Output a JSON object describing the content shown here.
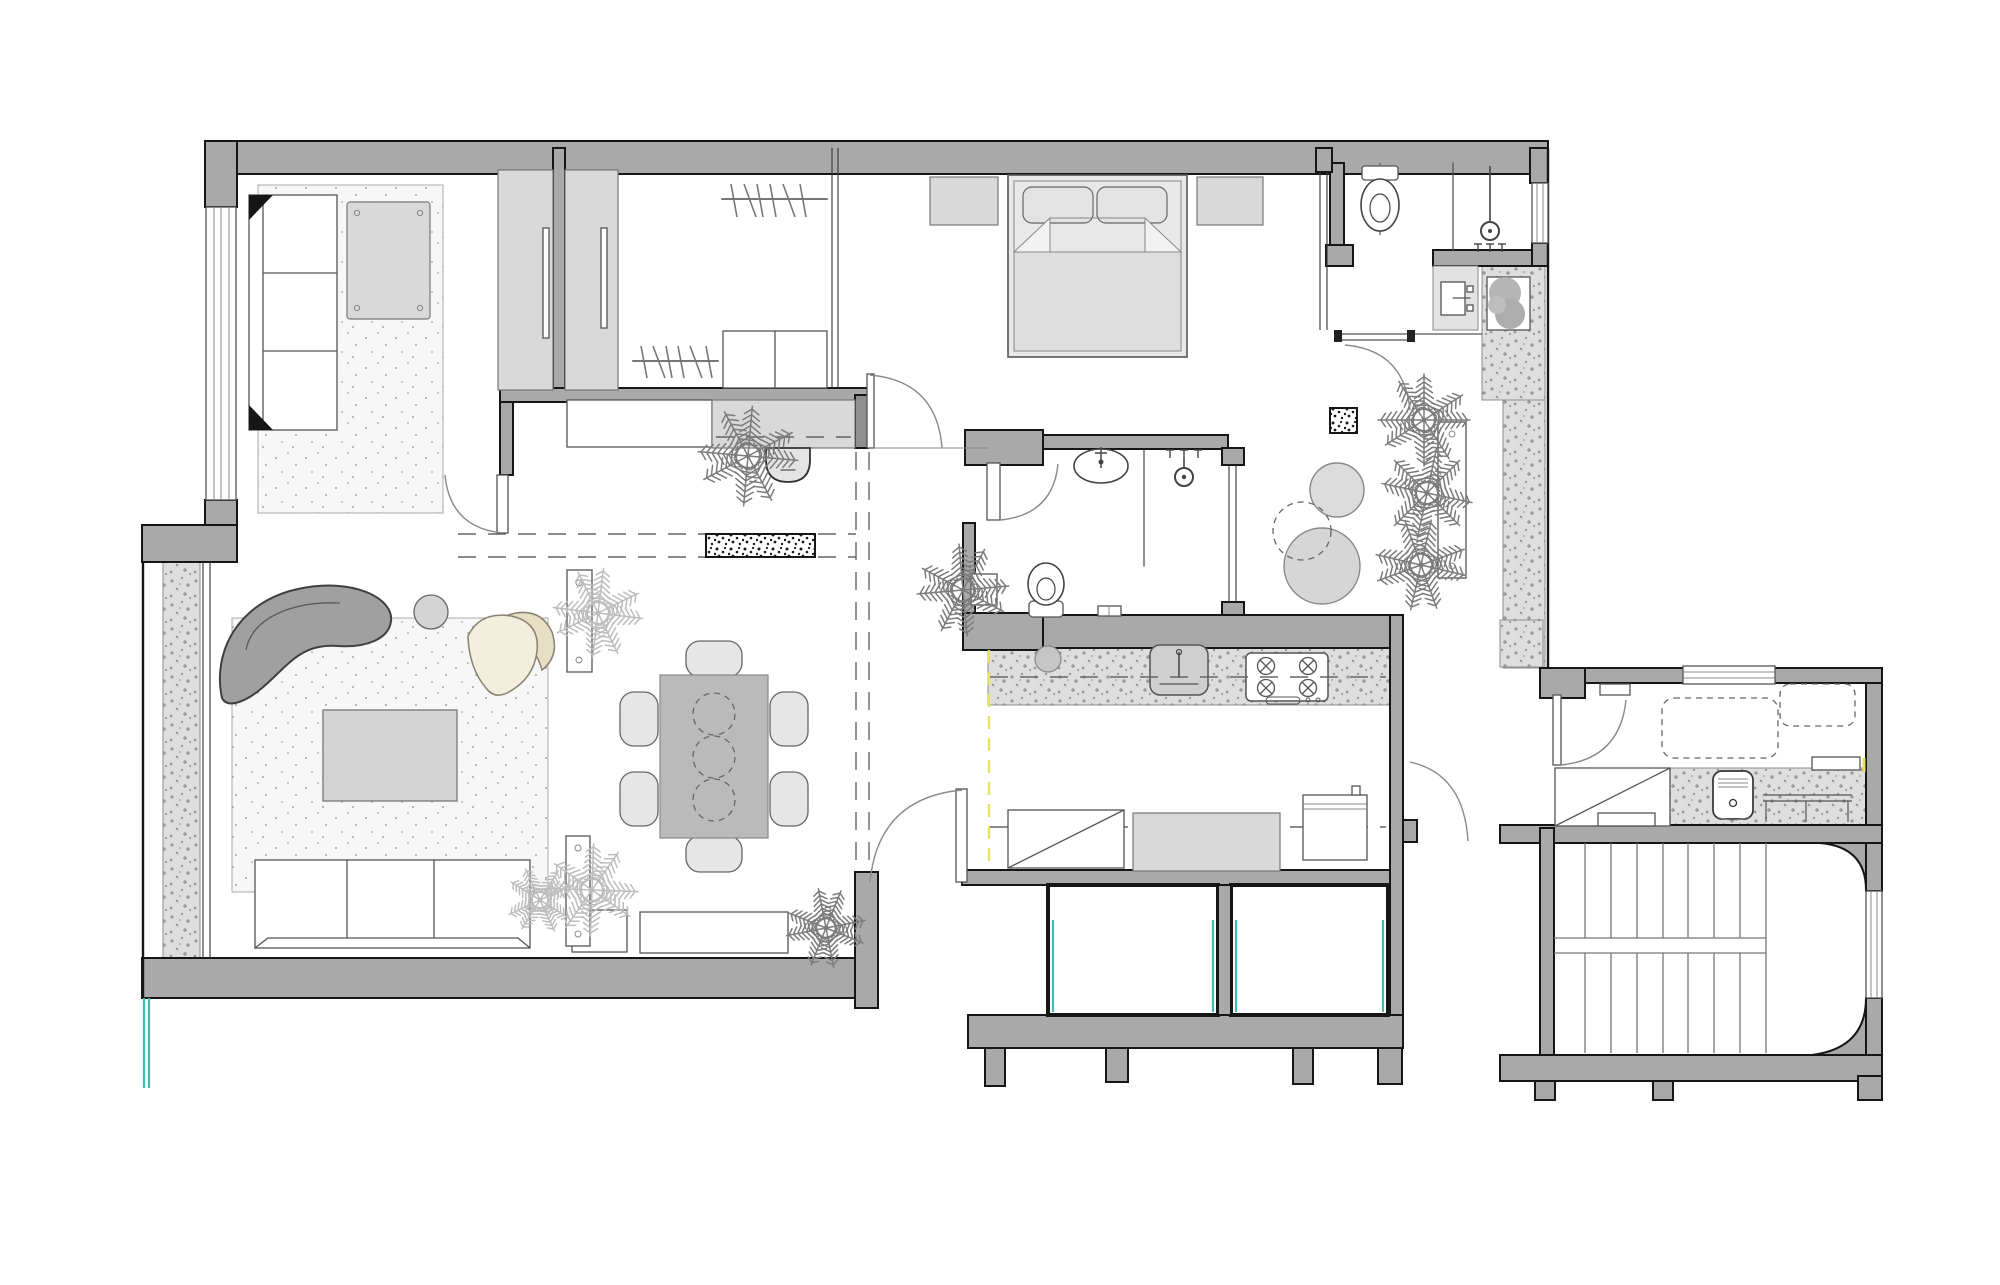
{
  "document": {
    "kind": "apartment-floor-plan-drawing",
    "visible_text": ""
  },
  "colors": {
    "wall": "#a9a9a9",
    "edge": "#161616",
    "furniture-gray": "#d9d9d9",
    "table-gray": "#bababa",
    "sofa-gray": "#a0a0a0",
    "rug-base": "#f7f7f7",
    "terrazzo-base": "#dedede",
    "speckle": "#9b9b9b",
    "palm-dark": "#7c7c7c",
    "palm-light": "#bdbdbd",
    "armchair-beige": "#f0e9d3",
    "teal": "#3fbdb0",
    "yellow": "#e6e45e"
  },
  "legend": {
    "fixtures": [
      "straight-sofa",
      "area-rug",
      "desk",
      "sliding-wardrobe",
      "clothes-rail",
      "dresser",
      "double-bed",
      "nightstand",
      "toilet",
      "shower-head",
      "vanity-sink",
      "oval-washbasin",
      "dining-table",
      "dining-chair",
      "curved-sofa",
      "lounge-armchair",
      "coffee-table",
      "side-table",
      "tv-console",
      "door-swing",
      "pocket-door",
      "kitchen-counter",
      "kitchen-sink",
      "gas-hob",
      "oven",
      "crossed-appliance-box",
      "washing-machine",
      "laundry-table",
      "staircase",
      "palm-plant",
      "planter-box",
      "window",
      "glass-partition"
    ],
    "counts": {
      "dining_chairs": 6,
      "dining_table_plates": 3,
      "hob_burners": 4,
      "clothes_rails": 2,
      "hangers_per_rail": 6,
      "courtyard_palms": 3,
      "stair_tread_lines_per_flight": 8,
      "light_wells": 2
    }
  }
}
